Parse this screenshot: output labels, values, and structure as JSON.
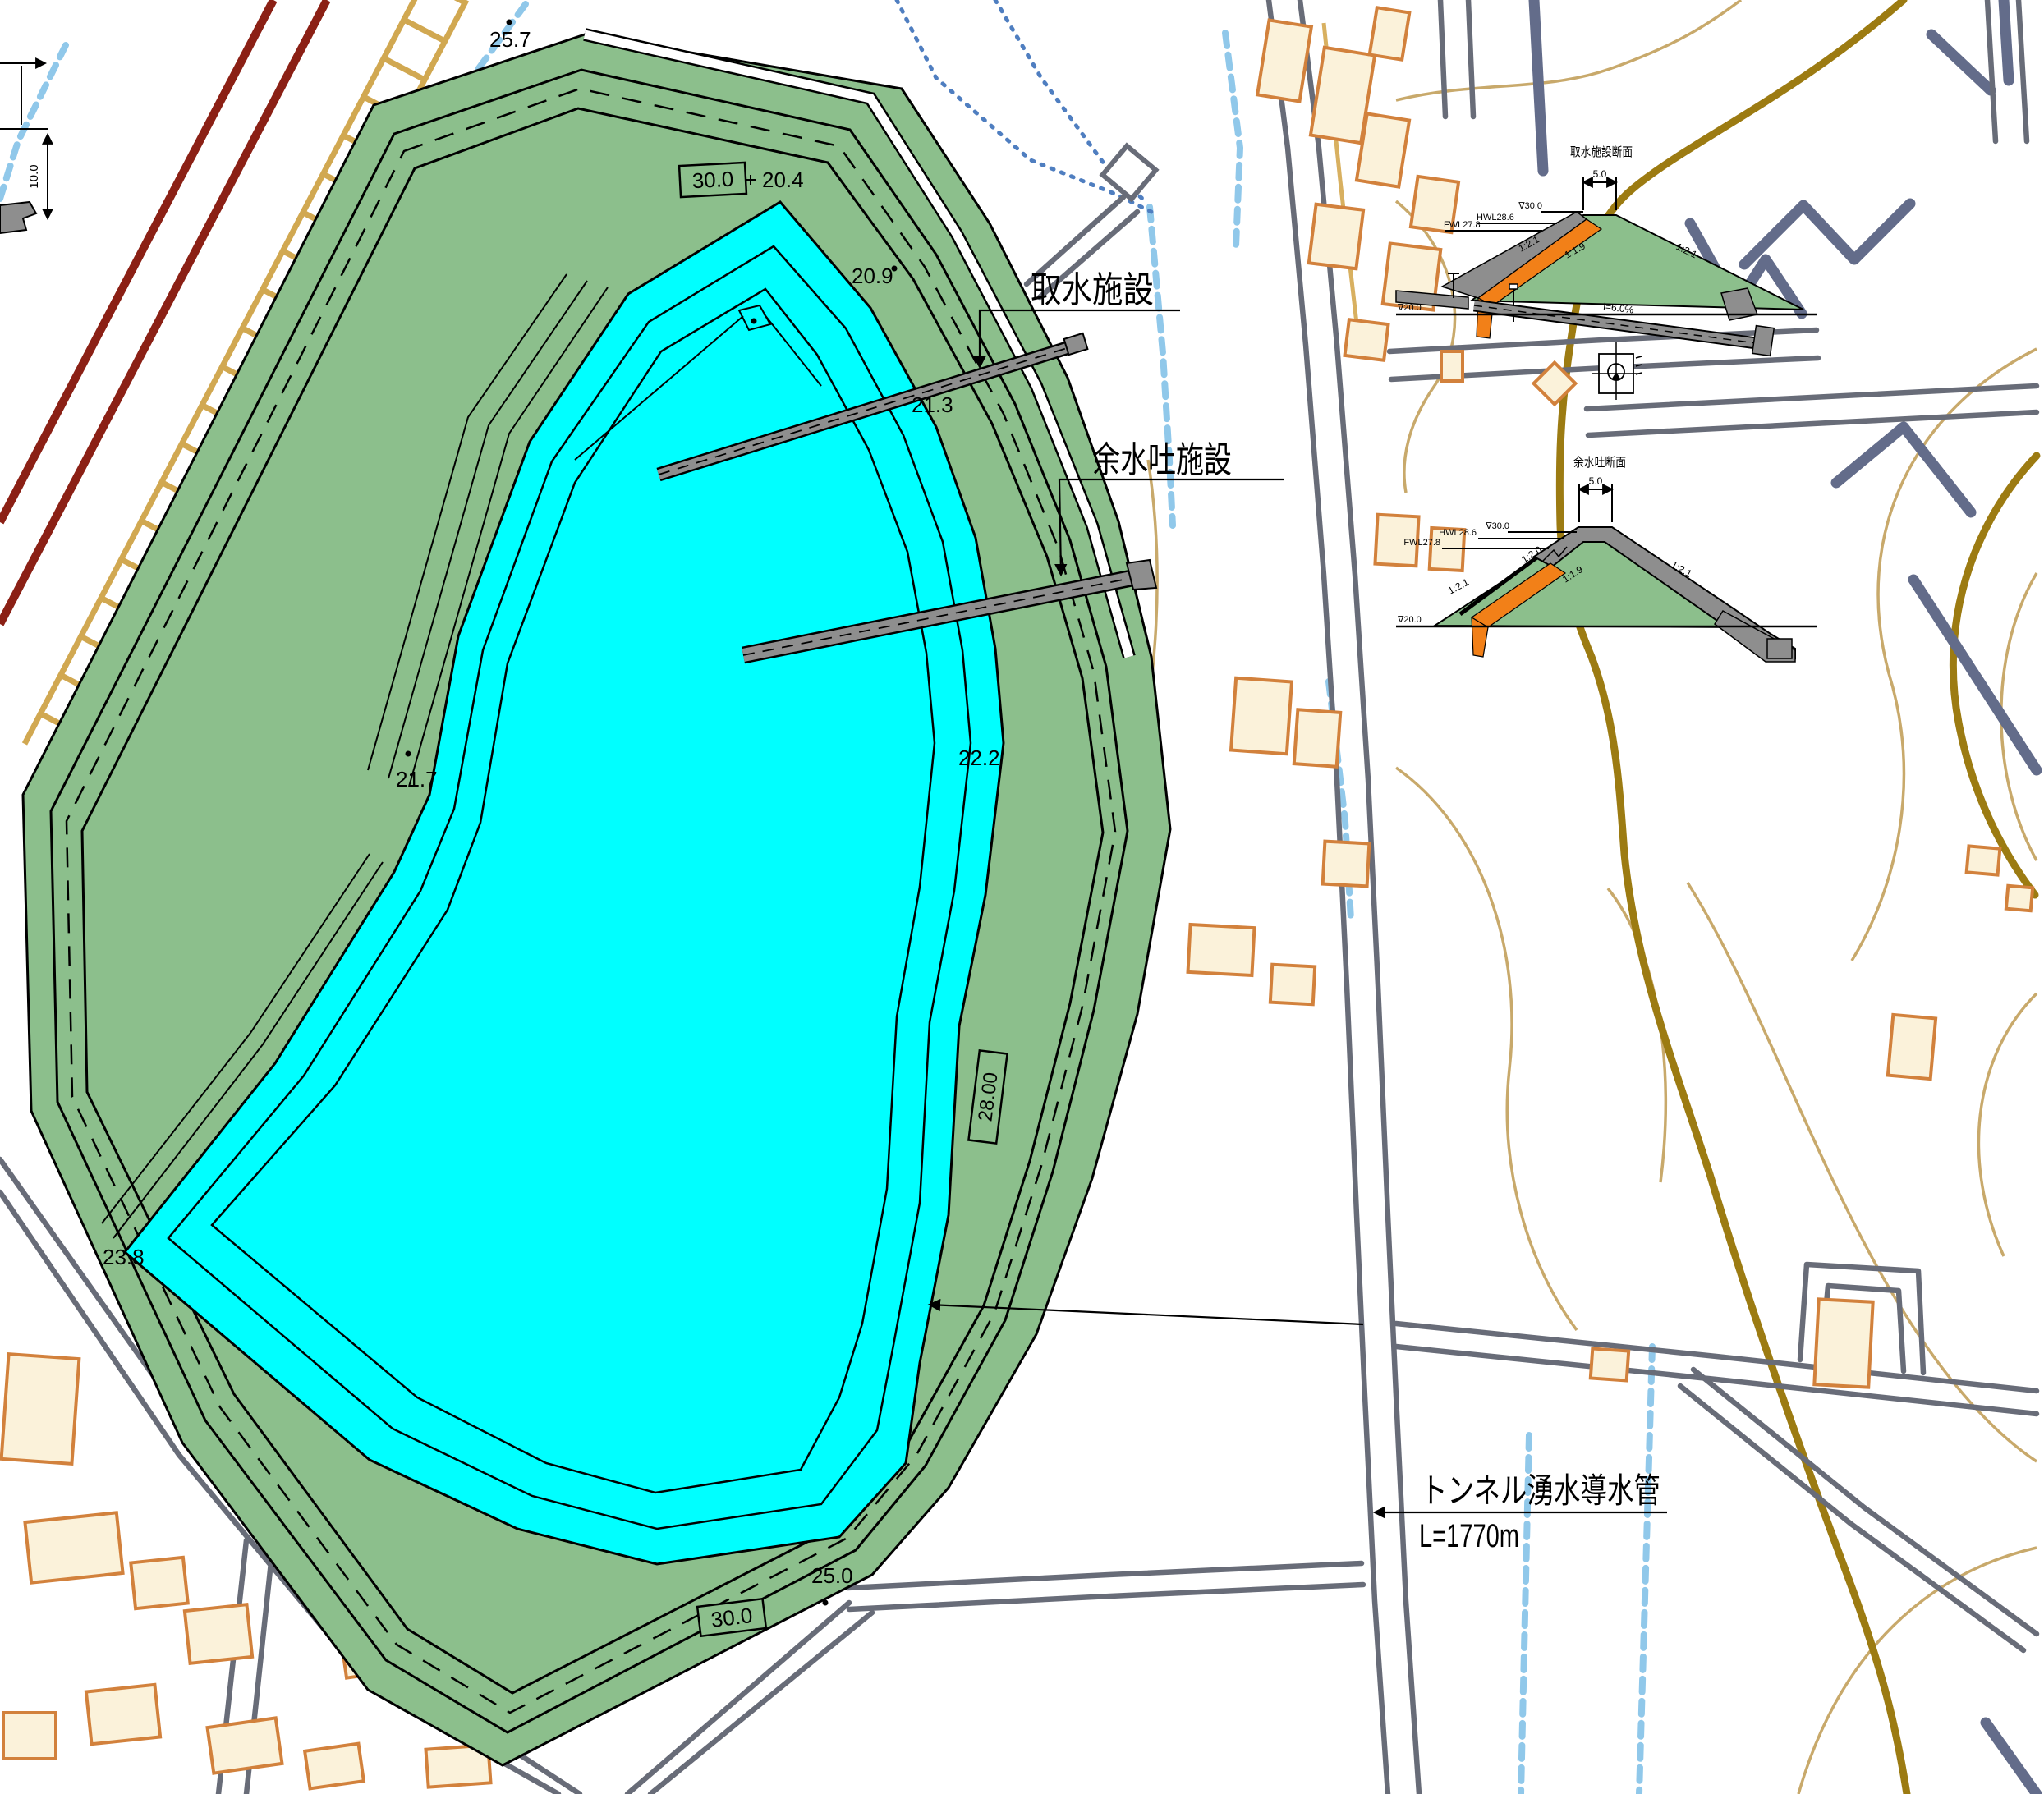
{
  "plan": {
    "callouts": {
      "intake": "取水施設",
      "spillway": "余水吐施設",
      "tunnel_line1": "トンネル湧水導水管",
      "tunnel_line2": "L=1770m"
    },
    "elevations": {
      "crest_top": "30.0",
      "e204": "20.4",
      "e209": "20.9",
      "e213": "21.3",
      "e217": "21.7",
      "e222": "22.2",
      "e238": "23.8",
      "e250": "25.0",
      "crest_bottom": "30.0",
      "berm_right": "28.00",
      "spot_257": "25.7",
      "spot_276": "27.6"
    },
    "edge_detail_dim": "10.0"
  },
  "sections": {
    "intake": {
      "title": "取水施設断面",
      "crest_width": "5.0",
      "crest_level": "∇30.0",
      "hwl": "HWL28.6",
      "fwl": "FWL27.8",
      "slope_upstream": "1:2.1",
      "slope_filter": "1:1.9",
      "slope_downstream": "1:2.1",
      "pipe_gradient": "i=6.0%",
      "ground_level": "∇20.0"
    },
    "spillway": {
      "title": "余水吐断面",
      "crest_width": "5.0",
      "crest_level": "∇30.0",
      "hwl": "HWL28.6",
      "fwl": "FWL27.8",
      "slope_inner_upper": "1:2.0",
      "slope_upstream": "1:2.1",
      "slope_filter": "1:1.9",
      "slope_downstream": "1:2.1",
      "ground_level": "∇20.0"
    }
  },
  "colors": {
    "water": "#00ffff",
    "embankment_green": "#8cbf8c",
    "filter_orange": "#f28018",
    "concrete_gray": "#8e8e8e",
    "railway_red": "#8b2015",
    "road_gray": "#686c78",
    "contour_major": "#9c7b12",
    "contour_minor": "#c8a96b",
    "stream_blue": "#90c8ea",
    "ditch_blue": "#4f7ec0",
    "building_stroke": "#d2813c",
    "building_fill": "#fbf2da",
    "ladder_tan": "#cfa448"
  }
}
